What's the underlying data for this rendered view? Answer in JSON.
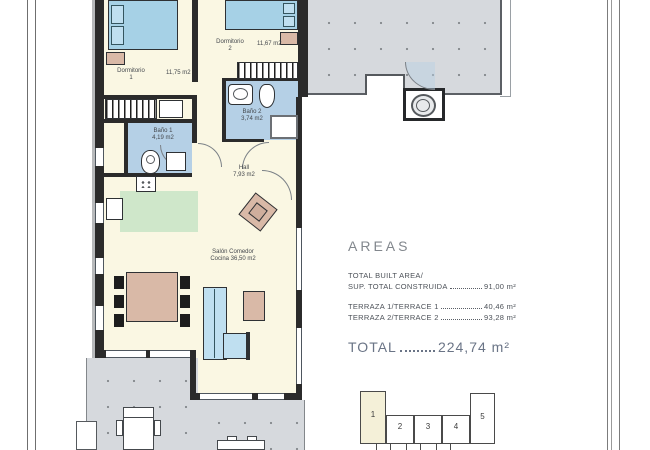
{
  "document": {
    "type": "architectural floor plan",
    "language": "Spanish/English"
  },
  "plan": {
    "rooms": {
      "dormitorio1": {
        "name": "Dormitorio",
        "number": "1",
        "area": "11,75 m2"
      },
      "dormitorio2": {
        "name": "Dormitorio",
        "number": "2",
        "area": "11,67 m2"
      },
      "bano1": {
        "name": "Baño 1",
        "area": "4,19 m2"
      },
      "bano2": {
        "name": "Baño 2",
        "area": "3,74 m2"
      },
      "hall": {
        "name": "Hall",
        "area": "7,93 m2"
      },
      "salon": {
        "name": "Salón Comedor",
        "area_line": "Cocina 36,50 m2"
      }
    }
  },
  "areas_panel": {
    "heading": "AREAS",
    "built_label_en": "TOTAL BUILT AREA/",
    "built_label_es": "SUP. TOTAL CONSTRUIDA",
    "built_value": "91,00 m²",
    "terrace1_label": "TERRAZA 1/TERRACE 1",
    "terrace1_value": "40,46 m²",
    "terrace2_label": "TERRAZA 2/TERRACE 2",
    "terrace2_value": "93,28 m²",
    "total_label": "TOTAL",
    "total_value": "224,74 m²"
  },
  "keyplan": {
    "units": [
      "1",
      "2",
      "3",
      "4",
      "5"
    ],
    "highlighted_unit": "1"
  },
  "colors": {
    "interior_cream": "#faf7e3",
    "bathroom_blue": "#b5d0e6",
    "kitchen_green": "#cfe7ca",
    "terrace_grey": "#d6d9dd",
    "furniture_tan": "#d9b9a7",
    "sofa_blue": "#bfdff0",
    "wall": "#2b2b2b",
    "highlight_unit": "#f4f0d8"
  }
}
